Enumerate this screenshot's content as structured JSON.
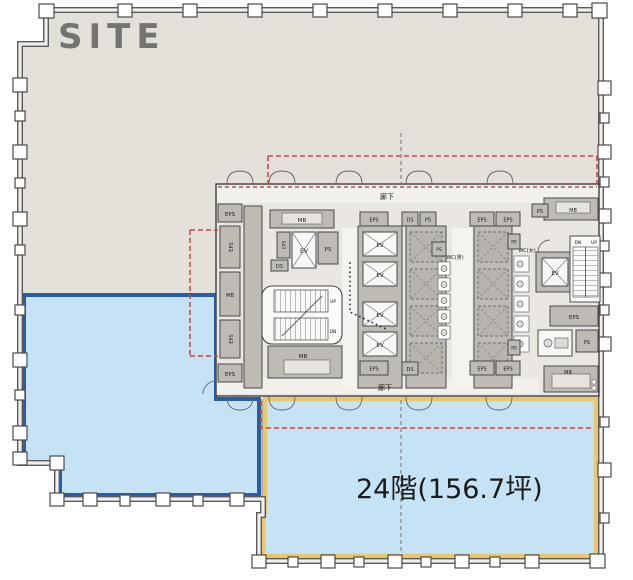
{
  "plan": {
    "title": "24階(156.7坪)",
    "watermark": "SITE",
    "corridor_label": "廊下",
    "rooms": {
      "eps": "EPS",
      "ps": "PS",
      "ds": "DS",
      "mb": "MB",
      "ev": "EV",
      "up": "UP",
      "dn": "DN",
      "wc_men": "WC(男)",
      "wc_women": "WC(女)"
    },
    "colors": {
      "office_gray": "#e3e0da",
      "core_gray": "#eae7e2",
      "zone_fill": "#c6e2f5",
      "zone_a_border": "#2b5ca8",
      "zone_b_border": "#e9c76b",
      "boundary_red": "#c84848",
      "wall": "#4a4a4a"
    }
  }
}
